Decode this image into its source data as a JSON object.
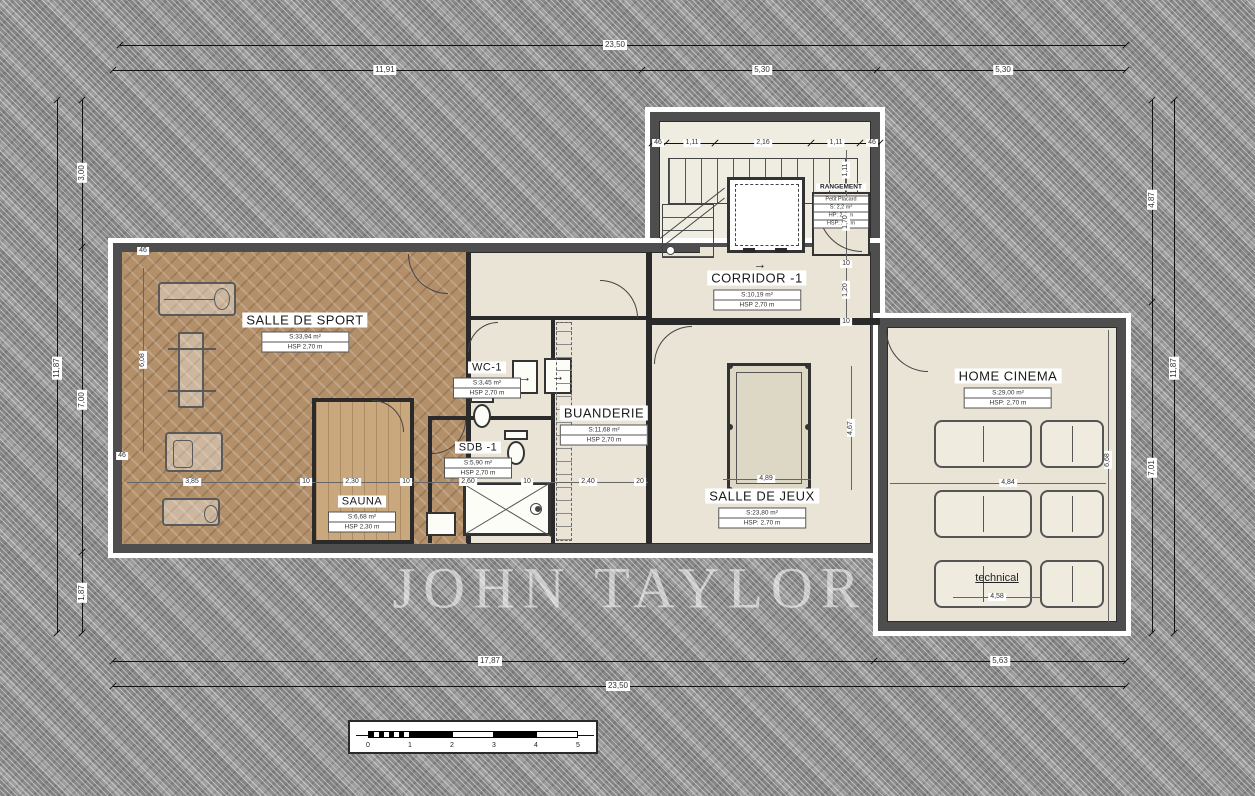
{
  "watermark": "JOHN TAYLOR",
  "icons": {
    "corridor_arrow": "→",
    "appliance_arrow_1": "→",
    "appliance_arrow_2": "→"
  },
  "rooms": {
    "sport": {
      "name": "SALLE DE SPORT",
      "area": "S:33,94 m²",
      "hsp": "HSP 2,70 m"
    },
    "wc": {
      "name": "WC-1",
      "area": "S:3,45 m²",
      "hsp": "HSP 2,70 m"
    },
    "sdb": {
      "name": "SDB -1",
      "area": "S:5,90 m²",
      "hsp": "HSP 2,70 m"
    },
    "sauna": {
      "name": "SAUNA",
      "area": "S:6,68 m²",
      "hsp": "HSP 2,30 m"
    },
    "buanderie": {
      "name": "BUANDERIE",
      "area": "S:11,68 m²",
      "hsp": "HSP 2,70 m"
    },
    "corridor": {
      "name": "CORRIDOR -1",
      "area": "S:10,19 m²",
      "hsp": "HSP 2,70 m"
    },
    "jeux": {
      "name": "SALLE DE JEUX",
      "area": "S:23,80 m²",
      "hsp": "HSP: 2,70 m"
    },
    "cinema": {
      "name": "HOME CINEMA",
      "area": "S:29,00 m²",
      "hsp": "HSP: 2,70 m"
    },
    "rangement": {
      "name": "RANGEMENT",
      "lines": [
        "Petit Placard",
        "S: 2,2 m²",
        "HP: 2,3 m",
        "HSP: 2,6 m"
      ]
    },
    "technical": {
      "name": "technical",
      "width": "4,58"
    }
  },
  "dims": {
    "top_total": "23,50",
    "top_seg": [
      "11,91",
      "5,30",
      "5,30"
    ],
    "bottom_seg": [
      "17,87",
      "5,63"
    ],
    "bottom_total": "23,50",
    "left_total": "11,87",
    "left_seg": [
      "3,00",
      "7,00",
      "1,87"
    ],
    "right_seg": [
      "4,87",
      "7,01"
    ],
    "right_total": "11,87",
    "stair_seg": [
      "46",
      "1,11",
      "2,16",
      "1,11",
      "46"
    ],
    "stair_side": [
      "1,11",
      "1,70"
    ],
    "corridor_ticks": [
      "10",
      "1,20",
      "10"
    ],
    "inner_row": [
      "3,85",
      "10",
      "2,30",
      "10",
      "2,60",
      "10",
      "2,40",
      "20"
    ],
    "wall_ticks": [
      "46",
      "46"
    ],
    "sport_h": "6,08",
    "jeux_w": "4,89",
    "jeux_h": "4,67",
    "cinema_w": "4,84",
    "cinema_h": "6,68"
  },
  "scalebar": {
    "labels": [
      "0",
      "1",
      "2",
      "3",
      "4",
      "5"
    ]
  }
}
